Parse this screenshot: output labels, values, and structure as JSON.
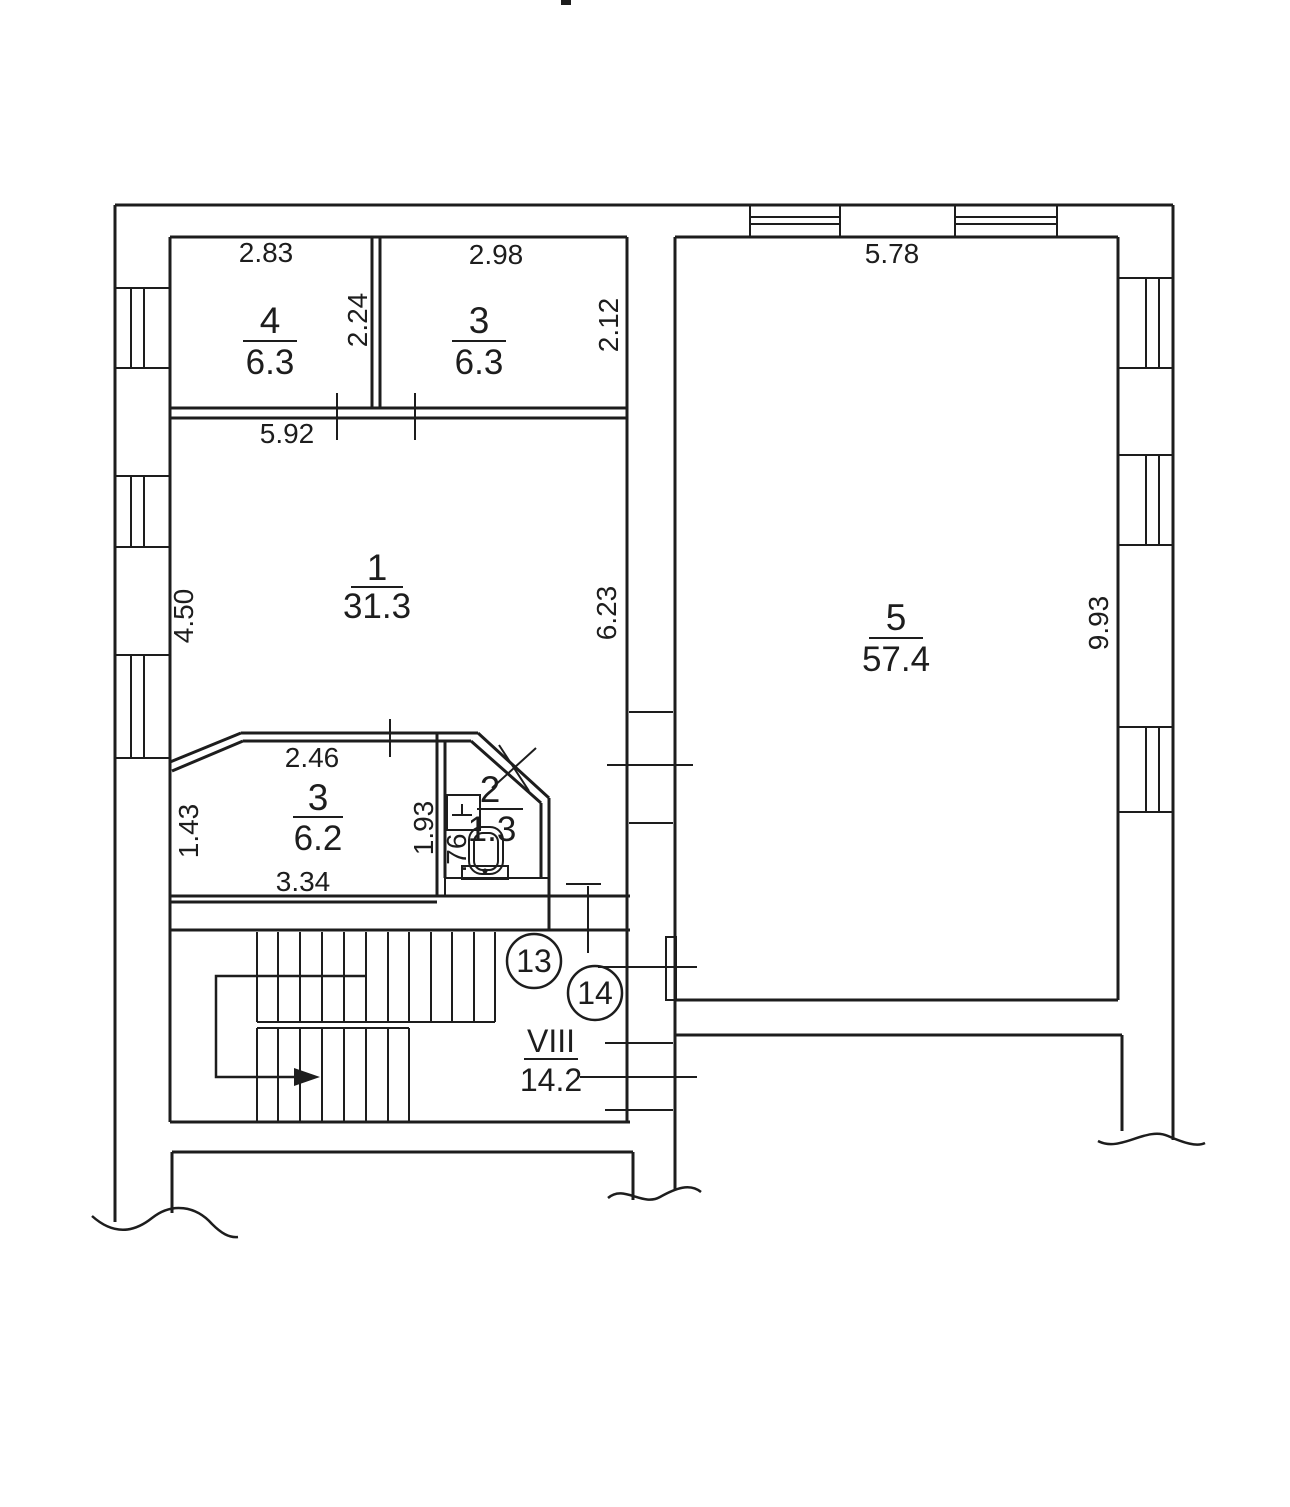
{
  "rooms": {
    "r4": {
      "number": "4",
      "area": "6.3"
    },
    "r3_top": {
      "number": "3",
      "area": "6.3"
    },
    "r1": {
      "number": "1",
      "area": "31.3"
    },
    "r5": {
      "number": "5",
      "area": "57.4"
    },
    "r3_low": {
      "number": "3",
      "area": "6.2"
    },
    "r2_wc": {
      "number": "2",
      "area": "1.3"
    },
    "hall": {
      "number": "VIII",
      "area": "14.2"
    }
  },
  "dims": {
    "room4_width": "2.83",
    "room3_top_width": "2.98",
    "room4_height": "2.24",
    "room3_top_height": "2.12",
    "room1_width": "5.92",
    "room1_left_height": "4.50",
    "room1_right_height": "6.23",
    "room5_width": "5.78",
    "room5_height": "9.93",
    "room3_low_top": "2.46",
    "room3_low_left": "1.43",
    "room3_low_bottom": "3.34",
    "wc_left_height": "1.93",
    "wc_inner_width": ".76"
  },
  "markers": {
    "m13": "13",
    "m14": "14"
  },
  "line_color": "#1d1d1d"
}
